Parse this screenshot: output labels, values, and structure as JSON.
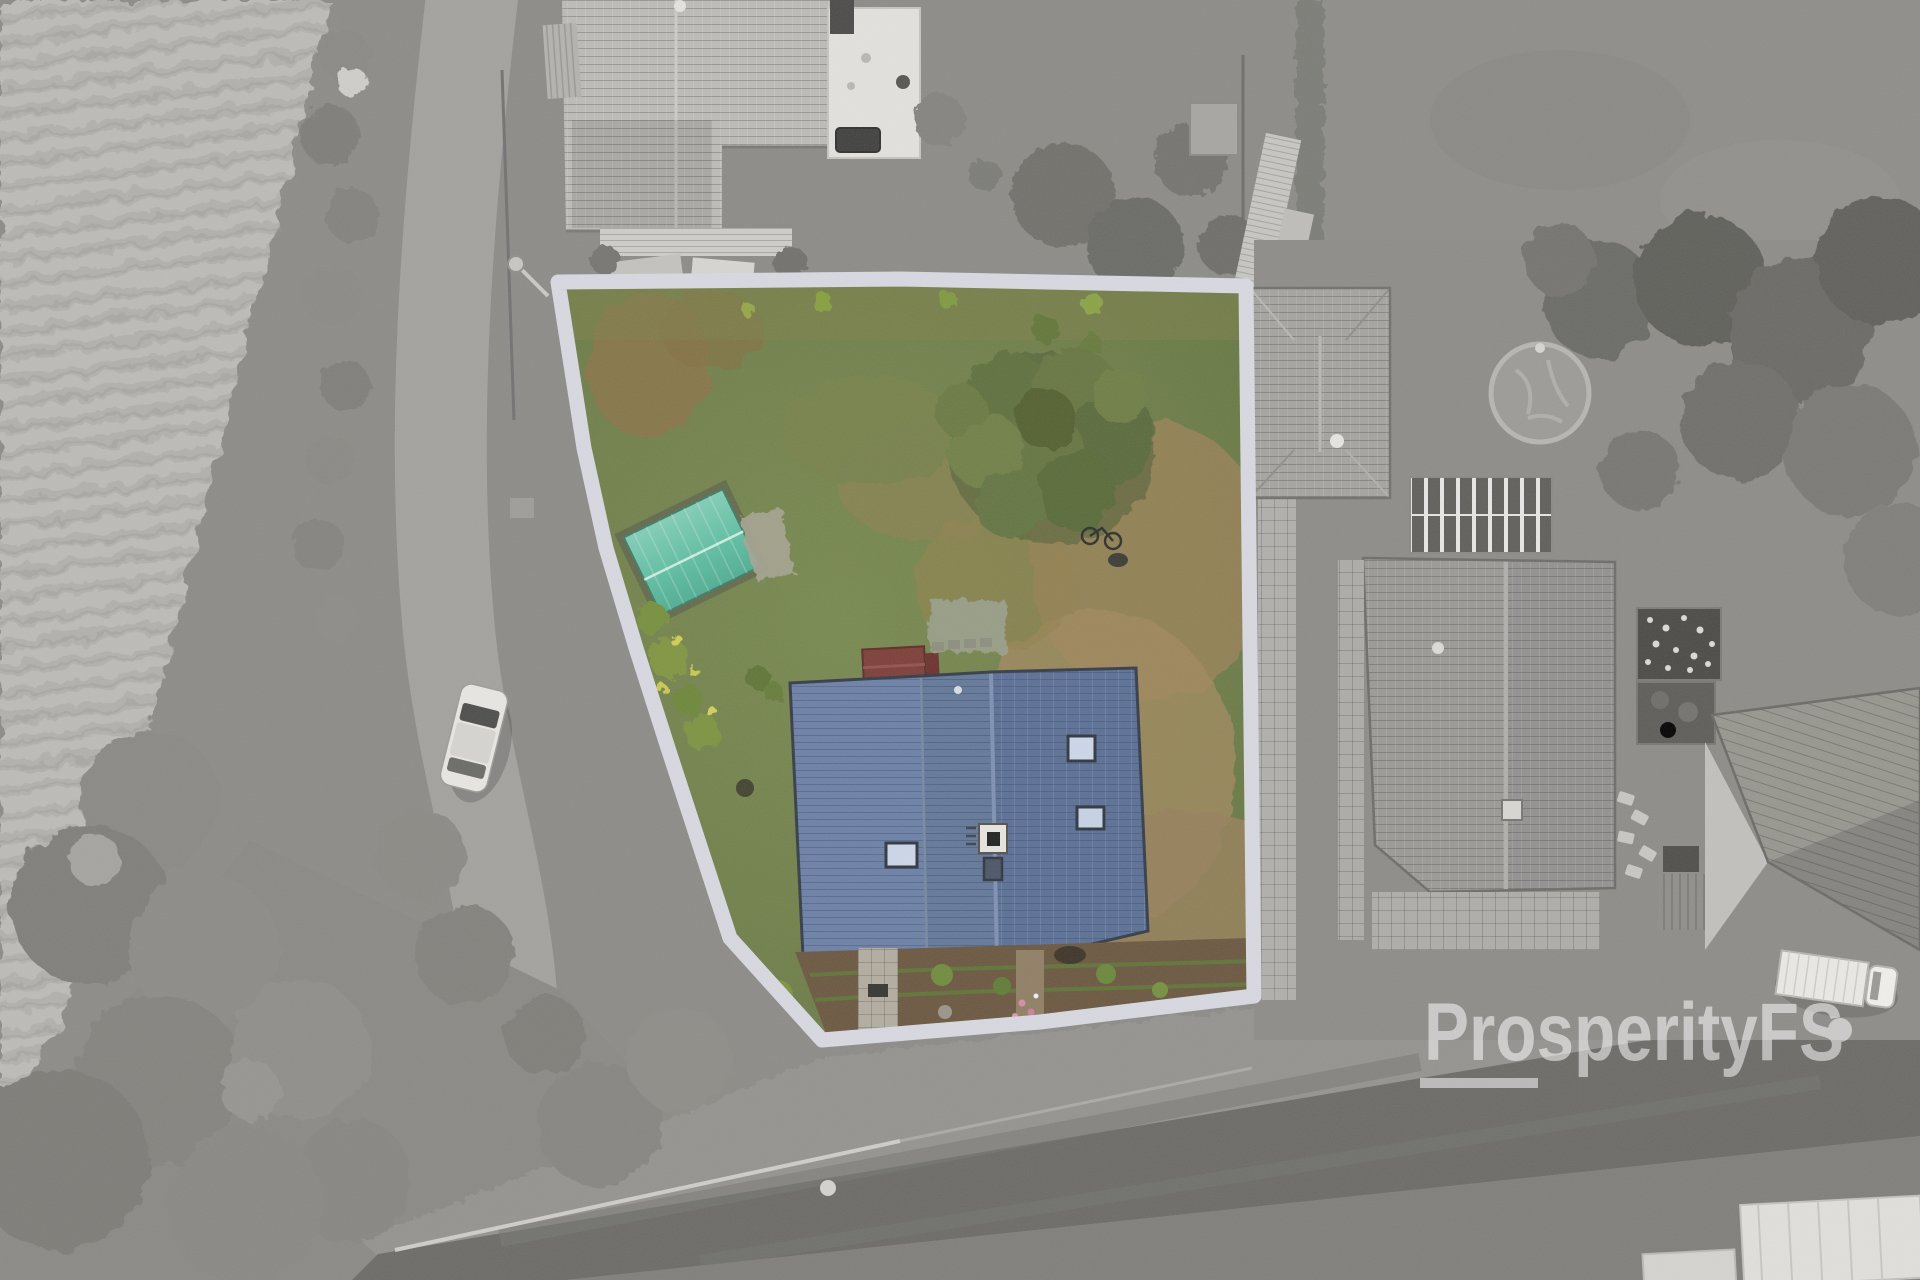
{
  "watermark": {
    "text": "ProsperityFS",
    "color": "#ffffff",
    "opacity": 0.52,
    "has_underline": true,
    "has_trailing_dot": true
  },
  "photo": {
    "style": "top-down aerial drone photo",
    "surroundings_treatment": "grayscale",
    "highlighted_plot_treatment": "full color with light boundary outline"
  },
  "colors": {
    "plot_boundary": "#d9dae2",
    "plot_grass": "#6e7e4a",
    "dry_grass": "#9b8156",
    "main_house_roof": "#5d7298",
    "garden_shed_roof": "#5fc0a4",
    "large_tree": "#5a6a3a",
    "road_asphalt": "#6b6a67",
    "mown_field": "#b3b2ae",
    "neighbor_roof": "#a5a4a0"
  }
}
